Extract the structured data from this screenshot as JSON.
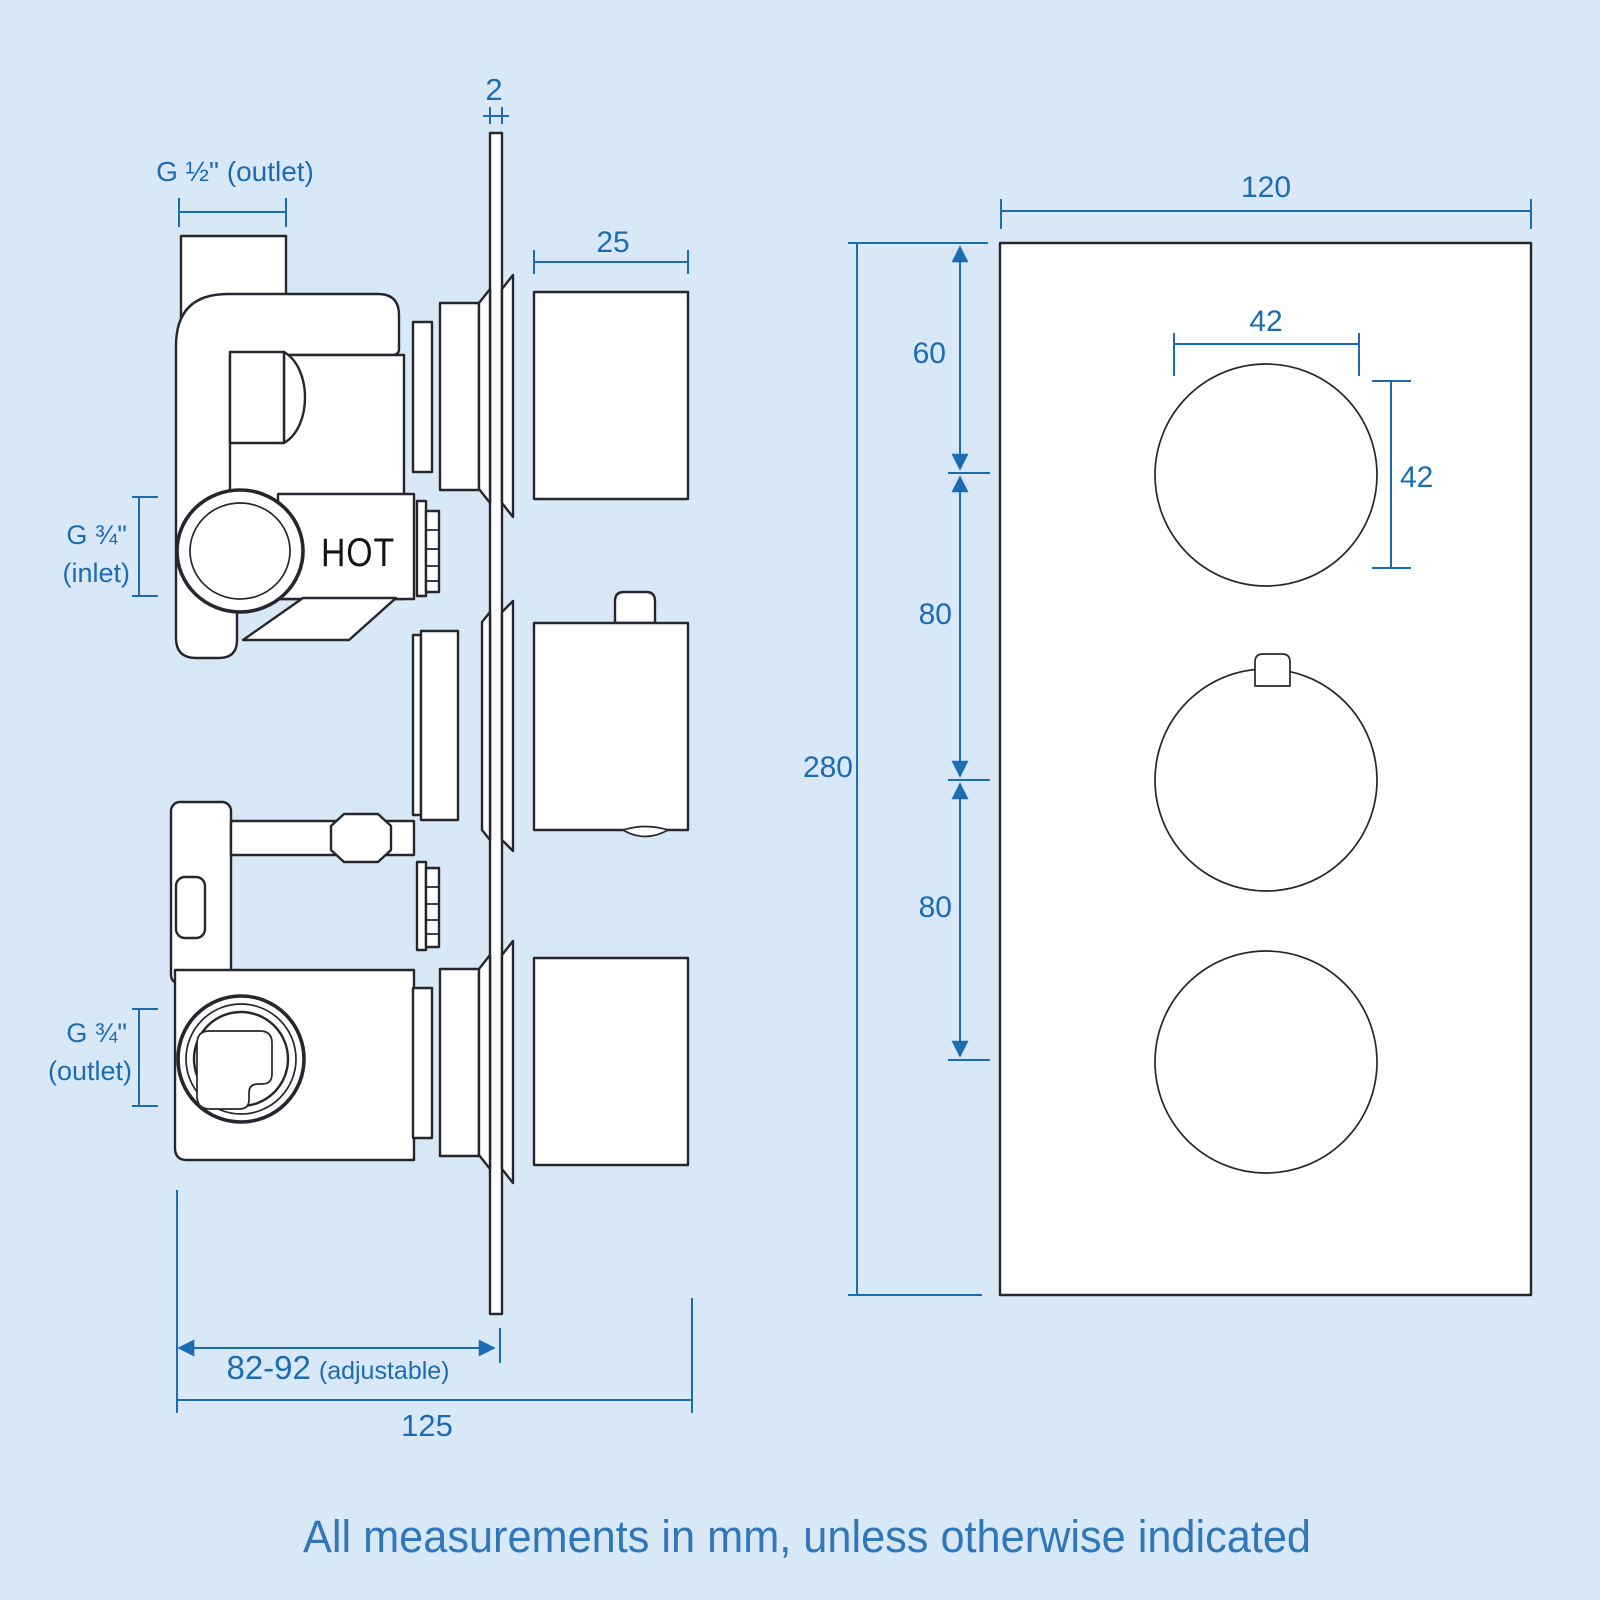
{
  "colors": {
    "bg": "#d9e8f7",
    "line": "#26262e",
    "dim": "#1b6cb3",
    "footer": "#2f77ba",
    "hot": "#141414"
  },
  "side_view": {
    "description": "Side profile of concealed triple thermostatic shower valve",
    "dims": {
      "outlet_top": "G ½\" (outlet)",
      "plate_thickness": "2",
      "knob_depth": "25",
      "inlet_l1": "G ¾\"",
      "inlet_l2": "(inlet)",
      "hot": "HOT",
      "outlet_bottom_l1": "G ¾\"",
      "outlet_bottom_l2": "(outlet)",
      "adjust_value": "82-92",
      "adjust_note": "(adjustable)",
      "overall_depth": "125"
    }
  },
  "front_view": {
    "description": "Front view of valve trim plate with three round knobs",
    "dims": {
      "width": "120",
      "top_offset": "60",
      "knob_dia_h": "42",
      "knob_dia_v": "42",
      "spacing_upper": "80",
      "height": "280",
      "spacing_lower": "80"
    }
  },
  "footer": {
    "note": "All measurements in mm, unless otherwise indicated"
  }
}
